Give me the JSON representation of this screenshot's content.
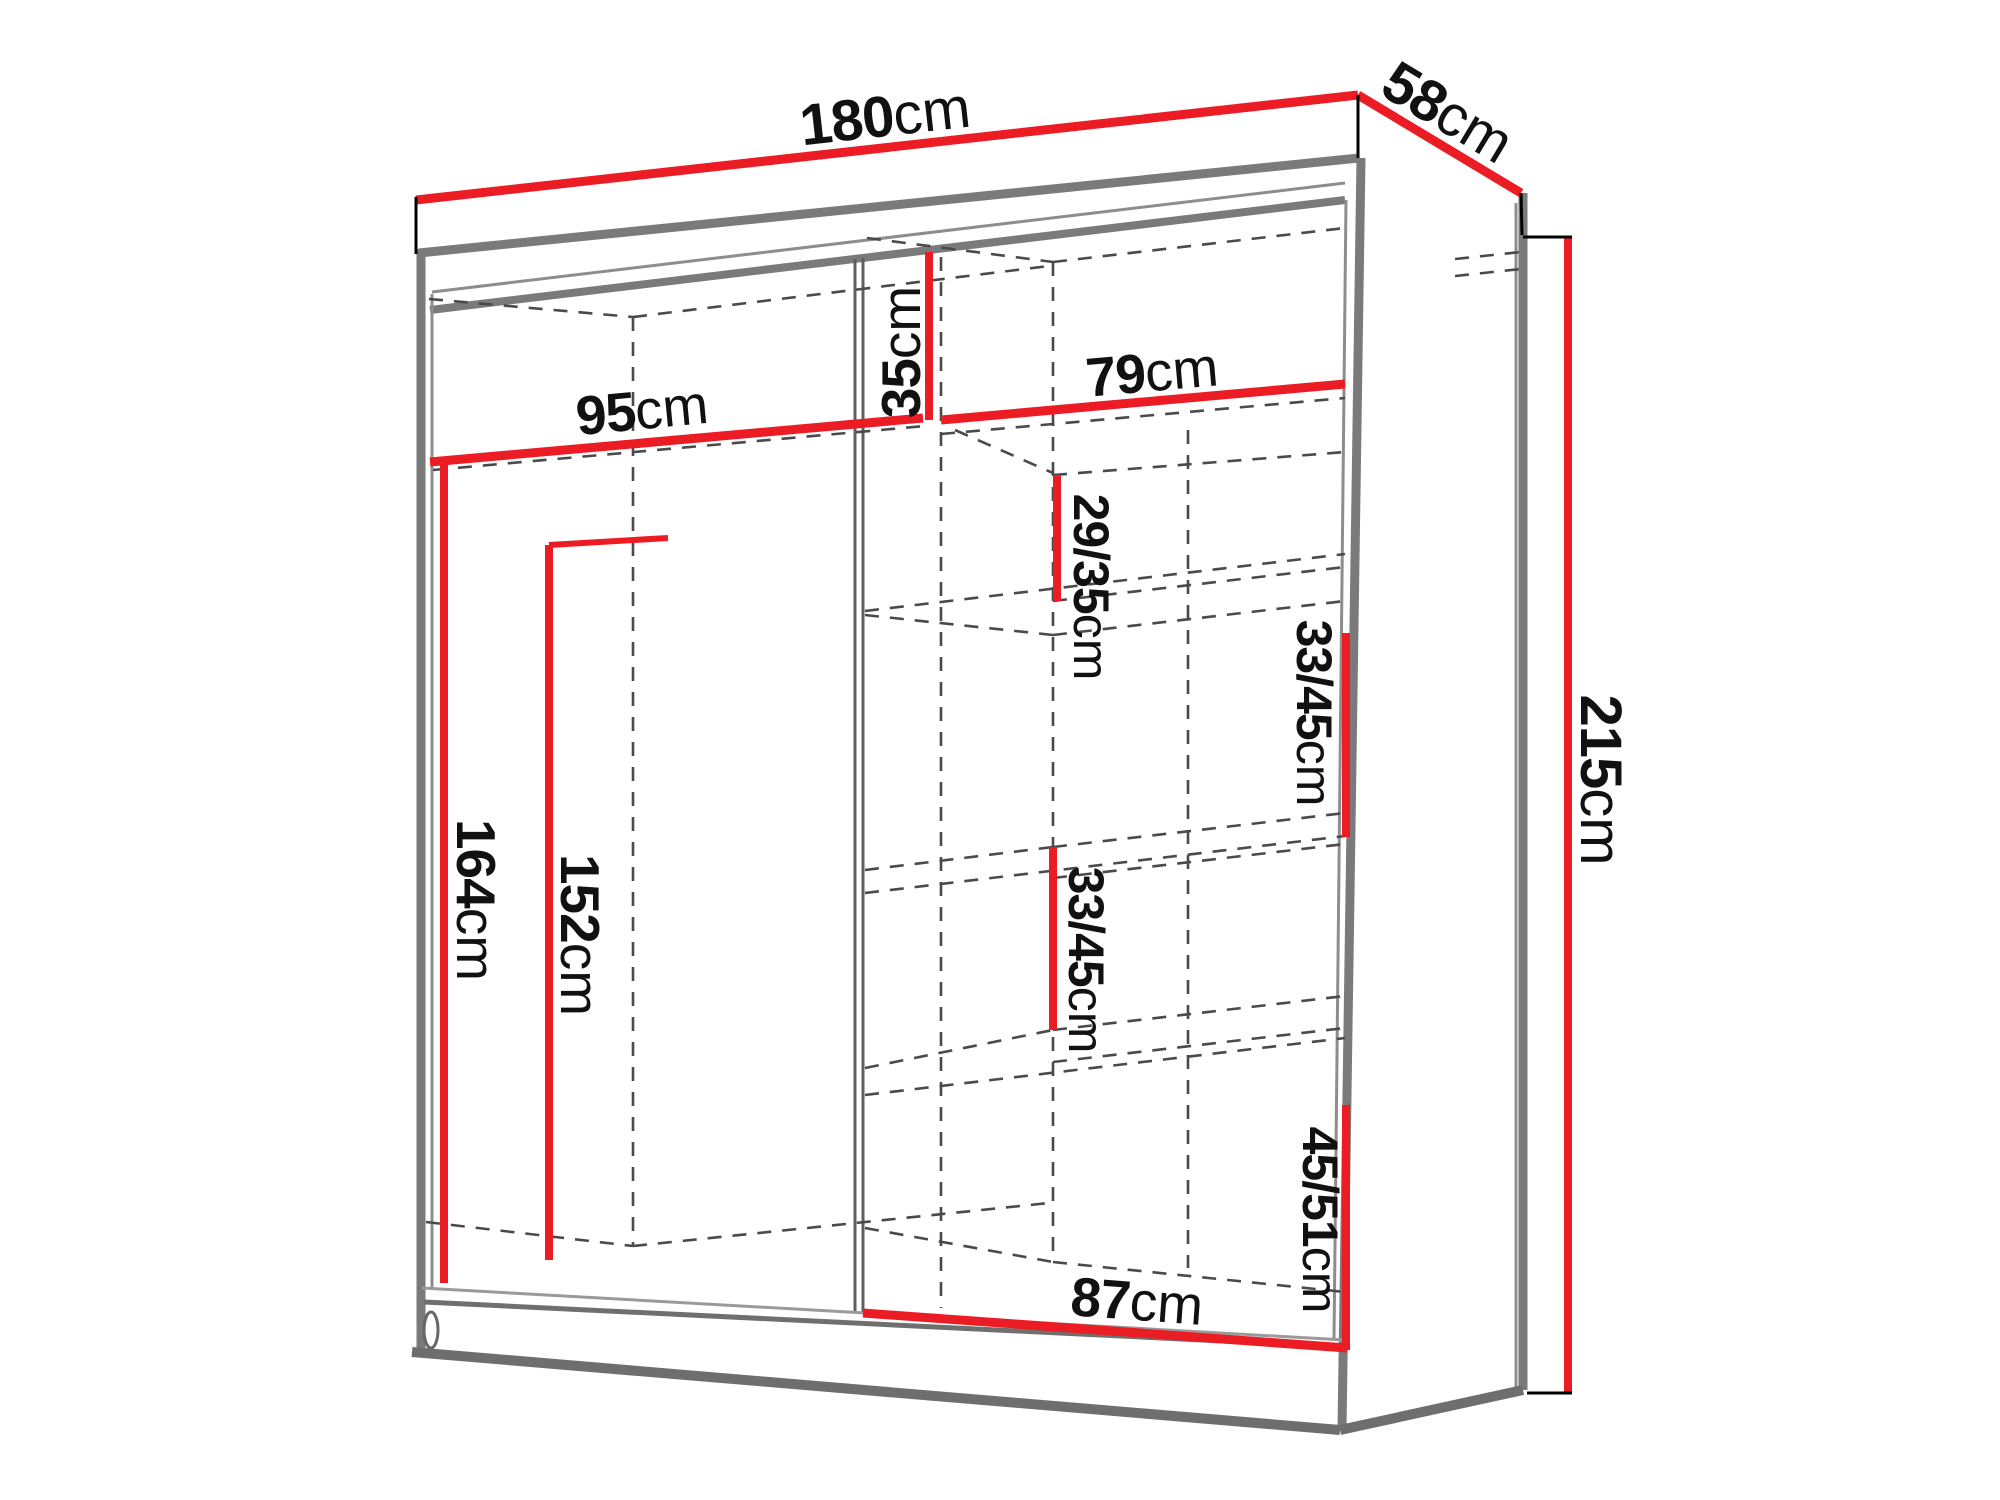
{
  "diagram": {
    "type": "wardrobe-dimension-diagram",
    "unit_system": "cm",
    "colors": {
      "dimension_line": "#ec1c24",
      "outline_gray": "#7a7a7a",
      "dashed_line": "#4a4a4a",
      "label_text": "#111111",
      "background": "#ffffff"
    },
    "dimensions": [
      {
        "id": "overall-width",
        "value": "180",
        "unit": "cm"
      },
      {
        "id": "overall-depth",
        "value": "58",
        "unit": "cm"
      },
      {
        "id": "overall-height",
        "value": "215",
        "unit": "cm"
      },
      {
        "id": "left-section-width",
        "value": "95",
        "unit": "cm"
      },
      {
        "id": "top-compartment-height",
        "value": "35",
        "unit": "cm"
      },
      {
        "id": "right-section-width",
        "value": "79",
        "unit": "cm"
      },
      {
        "id": "cubby-1-height",
        "value": "29/35",
        "unit": "cm"
      },
      {
        "id": "cubby-2-height",
        "value": "33/45",
        "unit": "cm"
      },
      {
        "id": "cubby-3-height",
        "value": "33/45",
        "unit": "cm"
      },
      {
        "id": "cubby-4-height",
        "value": "45/51",
        "unit": "cm"
      },
      {
        "id": "left-hanging-height",
        "value": "164",
        "unit": "cm"
      },
      {
        "id": "left-inner-height",
        "value": "152",
        "unit": "cm"
      },
      {
        "id": "bottom-section-width",
        "value": "87",
        "unit": "cm"
      }
    ]
  }
}
